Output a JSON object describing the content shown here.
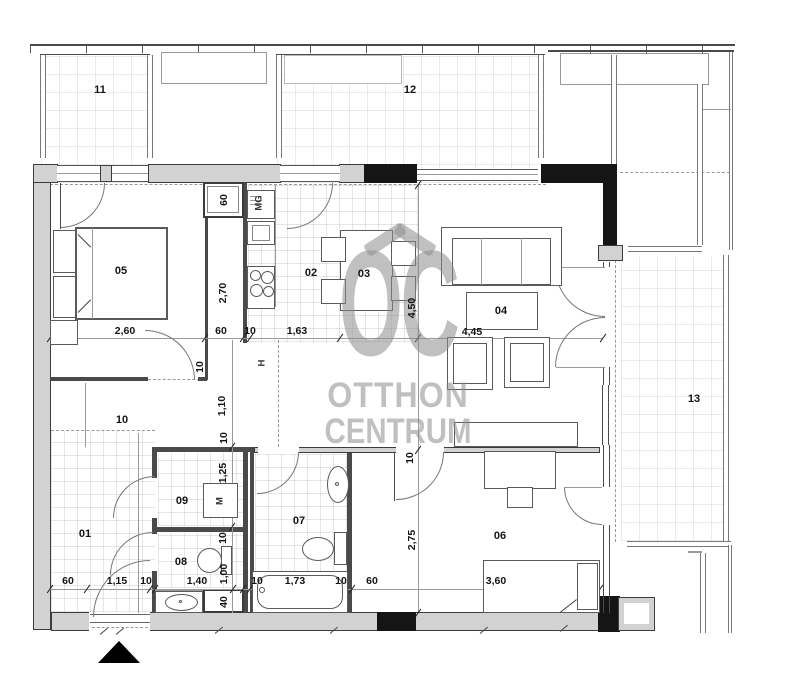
{
  "watermark": {
    "logo_text": "OC",
    "line1": "OTTHON",
    "line2": "CENTRUM",
    "color": "#8c8c8c"
  },
  "rooms": [
    {
      "text": "01",
      "x": 85,
      "y": 534
    },
    {
      "text": "02",
      "x": 311,
      "y": 273
    },
    {
      "text": "03",
      "x": 364,
      "y": 274
    },
    {
      "text": "04",
      "x": 501,
      "y": 311
    },
    {
      "text": "05",
      "x": 121,
      "y": 271
    },
    {
      "text": "06",
      "x": 500,
      "y": 536
    },
    {
      "text": "07",
      "x": 299,
      "y": 521
    },
    {
      "text": "08",
      "x": 181,
      "y": 562
    },
    {
      "text": "09",
      "x": 182,
      "y": 501
    },
    {
      "text": "10",
      "x": 122,
      "y": 420
    },
    {
      "text": "11",
      "x": 100,
      "y": 90
    },
    {
      "text": "12",
      "x": 410,
      "y": 90
    },
    {
      "text": "13",
      "x": 694,
      "y": 399
    }
  ],
  "dimensions": [
    {
      "text": "2,60",
      "x": 125,
      "y": 331
    },
    {
      "text": "60",
      "x": 224,
      "y": 200,
      "rot": 1
    },
    {
      "text": "2,70",
      "x": 223,
      "y": 293,
      "rot": 1
    },
    {
      "text": "60",
      "x": 221,
      "y": 331
    },
    {
      "text": "10",
      "x": 250,
      "y": 331
    },
    {
      "text": "1,63",
      "x": 297,
      "y": 331
    },
    {
      "text": "4,45",
      "x": 472,
      "y": 332
    },
    {
      "text": "4,50",
      "x": 412,
      "y": 308,
      "rot": 1
    },
    {
      "text": "10",
      "x": 410,
      "y": 458,
      "rot": 1
    },
    {
      "text": "2,75",
      "x": 412,
      "y": 540,
      "rot": 1
    },
    {
      "text": "10",
      "x": 200,
      "y": 367,
      "rot": 1
    },
    {
      "text": "1,10",
      "x": 222,
      "y": 406,
      "rot": 1
    },
    {
      "text": "10",
      "x": 224,
      "y": 438,
      "rot": 1
    },
    {
      "text": "1,25",
      "x": 223,
      "y": 473,
      "rot": 1
    },
    {
      "text": "10",
      "x": 223,
      "y": 538,
      "rot": 1
    },
    {
      "text": "1,00",
      "x": 224,
      "y": 574,
      "rot": 1
    },
    {
      "text": "40",
      "x": 224,
      "y": 602,
      "rot": 1
    },
    {
      "text": "60",
      "x": 68,
      "y": 581
    },
    {
      "text": "1,15",
      "x": 117,
      "y": 581
    },
    {
      "text": "10",
      "x": 146,
      "y": 581
    },
    {
      "text": "1,40",
      "x": 197,
      "y": 581
    },
    {
      "text": "10",
      "x": 257,
      "y": 581
    },
    {
      "text": "1,73",
      "x": 295,
      "y": 581
    },
    {
      "text": "10",
      "x": 341,
      "y": 581
    },
    {
      "text": "60",
      "x": 372,
      "y": 581
    },
    {
      "text": "3,60",
      "x": 496,
      "y": 581
    }
  ],
  "tags": [
    {
      "text": "M",
      "x": 220,
      "y": 501,
      "rot": 1
    },
    {
      "text": "MG",
      "x": 259,
      "y": 203,
      "rot": 1
    },
    {
      "text": "H",
      "x": 262,
      "y": 363,
      "rot": 1
    }
  ],
  "colors": {
    "wall_gray": "#d2d2d2",
    "wall_black": "#151515",
    "line": "#4a4a4a",
    "grid": "#787878"
  }
}
